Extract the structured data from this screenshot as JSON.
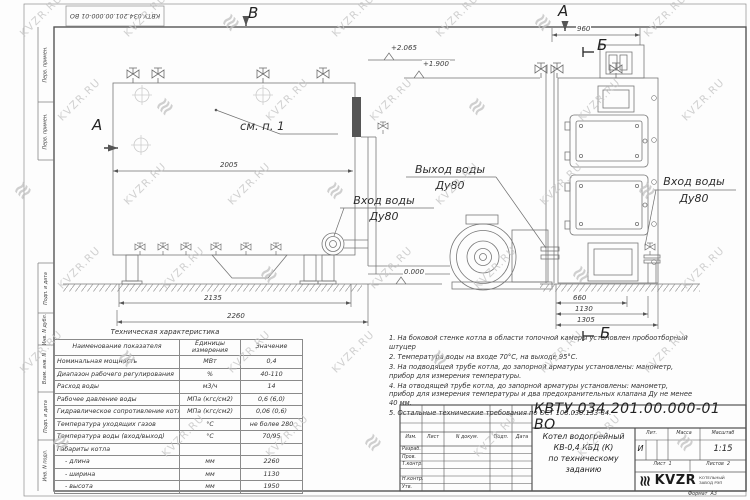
{
  "watermark": {
    "text": "KVZR.RU",
    "logo_glyph": "≋"
  },
  "frame": {
    "stamp_number": "КВТУ.034.201.00.000-01 ВО",
    "margin_cells": [
      "Перв. примен.",
      "Перв. примен.",
      "Подп. и дата",
      "Инв. N дубл.",
      "Взам. инв. N",
      "Подп. и дата",
      "Инв. N подл."
    ]
  },
  "labels": {
    "view_b": "В",
    "section_a_left": "А",
    "view_a_right": "А",
    "section_b_top": "Б",
    "section_b_bottom": "Б",
    "see_item": "см. п. 1",
    "outlet_line1": "Выход воды",
    "outlet_line2": "Ду80",
    "inlet_left_line1": "Вход воды",
    "inlet_left_line2": "Ду80",
    "inlet_right_line1": "Вход воды",
    "inlet_right_line2": "Ду80"
  },
  "dimensions": {
    "width_top": "2005",
    "width_frame": "2135",
    "width_total": "2260",
    "front_width": "960",
    "front_d1": "660",
    "front_d2": "1130",
    "front_d3": "1305",
    "level_top": "+2.065",
    "level_mid": "+1.900",
    "level_zero": "0.000"
  },
  "spec_table": {
    "title": "Техническая характеристика",
    "headers": [
      "Наименование показателя",
      "Единицы измерения",
      "Значение"
    ],
    "rows": [
      {
        "name": "Номинальная мощность",
        "unit": "МВт",
        "value": "0,4"
      },
      {
        "name": "Диапазон рабочего регулирования",
        "unit": "%",
        "value": "40-110"
      },
      {
        "name": "Расход воды",
        "unit": "м3/ч",
        "value": "14"
      },
      {
        "name": "Рабочее давление воды",
        "unit": "МПа (кгс/см2)",
        "value": "0,6 (6,0)"
      },
      {
        "name": "Гидравлическое сопротивление котла",
        "unit": "МПа (кгс/см2)",
        "value": "0,06 (0,6)"
      },
      {
        "name": "Температура уходящих газов",
        "unit": "°С",
        "value": "не более 280"
      },
      {
        "name": "Температура воды (вход/выход)",
        "unit": "°С",
        "value": "70/95"
      },
      {
        "name": "Габариты котла",
        "unit": "",
        "value": ""
      },
      {
        "name": "- длина",
        "unit": "мм",
        "value": "2260"
      },
      {
        "name": "- ширина",
        "unit": "мм",
        "value": "1130"
      },
      {
        "name": "- высота",
        "unit": "мм",
        "value": "1950"
      }
    ]
  },
  "notes": [
    "1. На боковой стенке котла в области топочной камеры установлен пробоотборный штуцер",
    "2. Температура воды на входе 70°С, на выходе 95°С.",
    "3. На подводящей трубе котла, до запорной арматуры установлены: манометр, прибор для измерения температуры.",
    "4. На отводящей трубе котла, до запорной арматуры установлены: манометр, прибор для измерения температуры и два предохранительных клапана Ду не менее 40 мм.",
    "5. Остальные технические требования по ОСТ 108.030.133-84."
  ],
  "title_block": {
    "doc_number": "КВТУ.034.201.00.000-01 ВО",
    "product_title_line1": "Котел водогрейный",
    "product_title_line2": "КВ-0,4 КБД (К)",
    "product_title_line3": "по техническому заданию",
    "col_izm": "Изм.",
    "col_list": "Лист",
    "col_ndoc": "N докум.",
    "col_podp": "Подп.",
    "col_data": "Дата",
    "row_razrab": "Разраб.",
    "row_prov": "Пров.",
    "row_tkontr": "Т.контр.",
    "row_nkontr": "Н.контр.",
    "row_utv": "Утв.",
    "lit_label": "Лит.",
    "mass_label": "Масса",
    "scale_label": "Масштаб",
    "lit_value": "И",
    "scale_value": "1:15",
    "sheet_label": "Лист",
    "sheet_value": "1",
    "sheets_label": "Листов",
    "sheets_value": "2",
    "logo_text": "KVZR",
    "logo_sub_line1": "КОТЕЛЬНЫЙ",
    "logo_sub_line2": "ЗАВОД РЭП",
    "format_label": "Формат",
    "format_value": "А3"
  }
}
